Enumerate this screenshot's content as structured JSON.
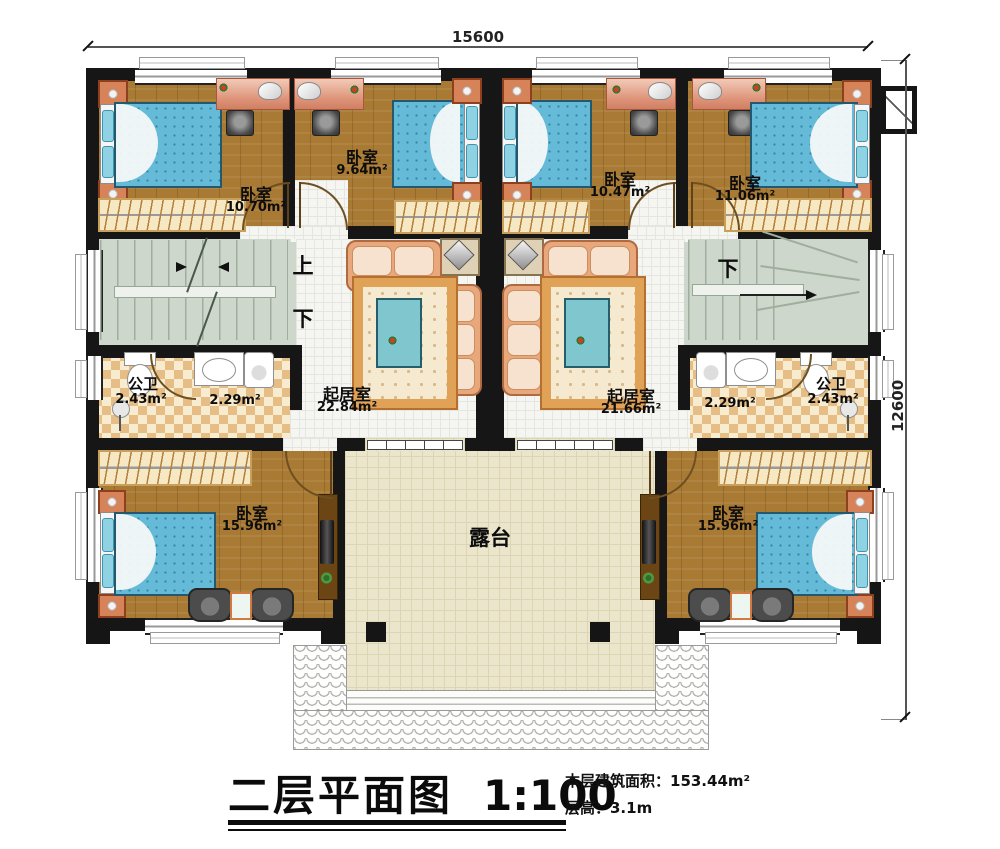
{
  "dimensions": {
    "top": "15600",
    "right": "12600"
  },
  "title_block": {
    "title": "二层平面图",
    "scale": "1:100",
    "info_line1": "本层建筑面积：153.44m²",
    "info_line2": "层高：3.1m"
  },
  "rooms": {
    "bedroom_top_left": {
      "name": "卧室",
      "area": "10.70m²"
    },
    "bedroom_top_mid_left": {
      "name": "卧室",
      "area": "9.64m²"
    },
    "bedroom_top_mid_right": {
      "name": "卧室",
      "area": "10.47m²"
    },
    "bedroom_top_right": {
      "name": "卧室",
      "area": "11.06m²"
    },
    "living_left": {
      "name": "起居室",
      "area": "22.84m²"
    },
    "living_right": {
      "name": "起居室",
      "area": "21.66m²"
    },
    "bath_left": {
      "name": "公卫",
      "area": "2.43m²"
    },
    "washroom_left": {
      "area": "2.29m²"
    },
    "bath_right": {
      "name": "公卫",
      "area": "2.43m²"
    },
    "washroom_right": {
      "area": "2.29m²"
    },
    "bedroom_bottom_left": {
      "name": "卧室",
      "area": "15.96m²"
    },
    "bedroom_bottom_right": {
      "name": "卧室",
      "area": "15.96m²"
    },
    "terrace": {
      "name": "露台"
    }
  },
  "stairs": {
    "up_left": "上",
    "down_left": "下",
    "down_right": "下"
  }
}
